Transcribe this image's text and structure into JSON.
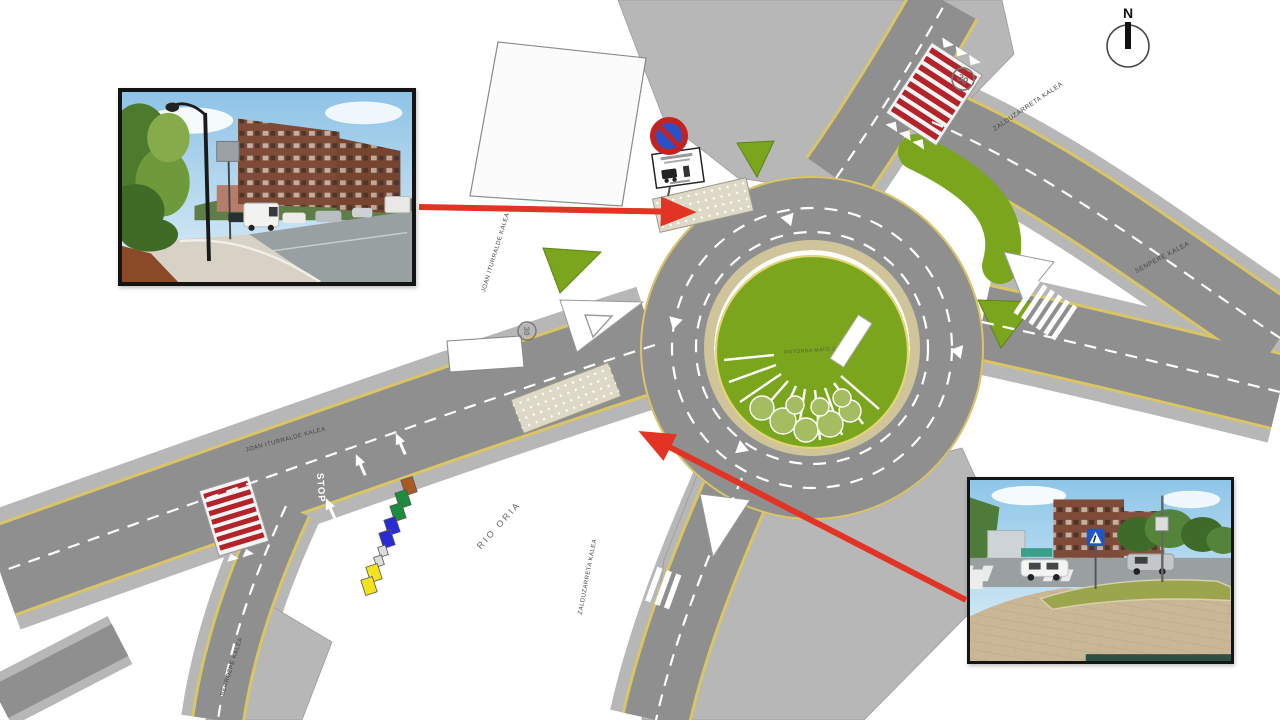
{
  "compass": {
    "label": "N"
  },
  "street_labels": {
    "zalduzarreta_north": "ZALDUZARRETA KALEA",
    "senpere": "SENPERE KALEA",
    "joan_iturralde_upper": "JOAN ITURRALDE KALEA",
    "joan_iturralde_lower": "JOAN ITURRALDE KALEA",
    "rio_oria": "RIO ORIA",
    "zalduzarreta_south": "ZALDUZARRETA KALEA",
    "berrozpe": "BERROZPE KALEA",
    "roundabout_center": "ROTONDA MATO 2"
  },
  "road_markings": {
    "stop": "STOP",
    "speed_limit_top": "30",
    "speed_limit_left": "30"
  },
  "icons": {
    "no_parking_sign": "no-parking-sign",
    "tow_away_sign": "tow-away-sign",
    "north_arrow": "north-arrow-compass",
    "pointer_arrows": "red-location-arrows"
  },
  "colors": {
    "asphalt": "#8f8f8f",
    "sidewalk": "#b7b7b7",
    "grass_green": "#7aa51c",
    "crosswalk_red": "#b3232a",
    "edge_line_yellow": "#d9c565",
    "pointer_arrow_red": "#e23424",
    "new_paving_tan": "#ded8c6",
    "container_brown": "#a85a20",
    "container_green": "#1e8c3f",
    "container_blue": "#2b2bd6",
    "container_yellow": "#f2e31d"
  }
}
